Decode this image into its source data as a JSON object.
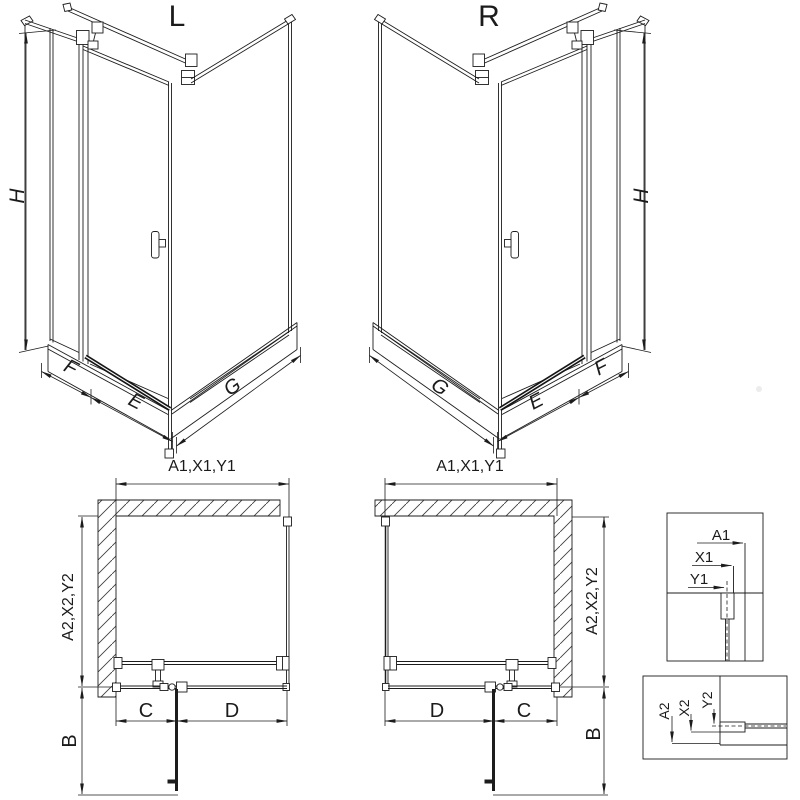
{
  "ink": "#1c1c1c",
  "background": "#ffffff",
  "iso_l": {
    "title": "L",
    "dim_h": "H",
    "dim_f": "F",
    "dim_e": "E",
    "dim_g": "G"
  },
  "iso_r": {
    "title": "R",
    "dim_h": "H",
    "dim_f": "F",
    "dim_e": "E",
    "dim_g": "G"
  },
  "plan_l": {
    "dim_width": "A1,X1,Y1",
    "dim_depth": "A2,X2,Y2",
    "dim_door_swing": "B",
    "dim_seg_left": "C",
    "dim_seg_right": "D"
  },
  "plan_r": {
    "dim_width": "A1,X1,Y1",
    "dim_depth": "A2,X2,Y2",
    "dim_door_swing": "B",
    "dim_seg_left": "D",
    "dim_seg_right": "C"
  },
  "detail_top": {
    "labels": [
      "A1",
      "X1",
      "Y1"
    ]
  },
  "detail_bottom": {
    "labels": [
      "A2",
      "X2",
      "Y2"
    ]
  }
}
